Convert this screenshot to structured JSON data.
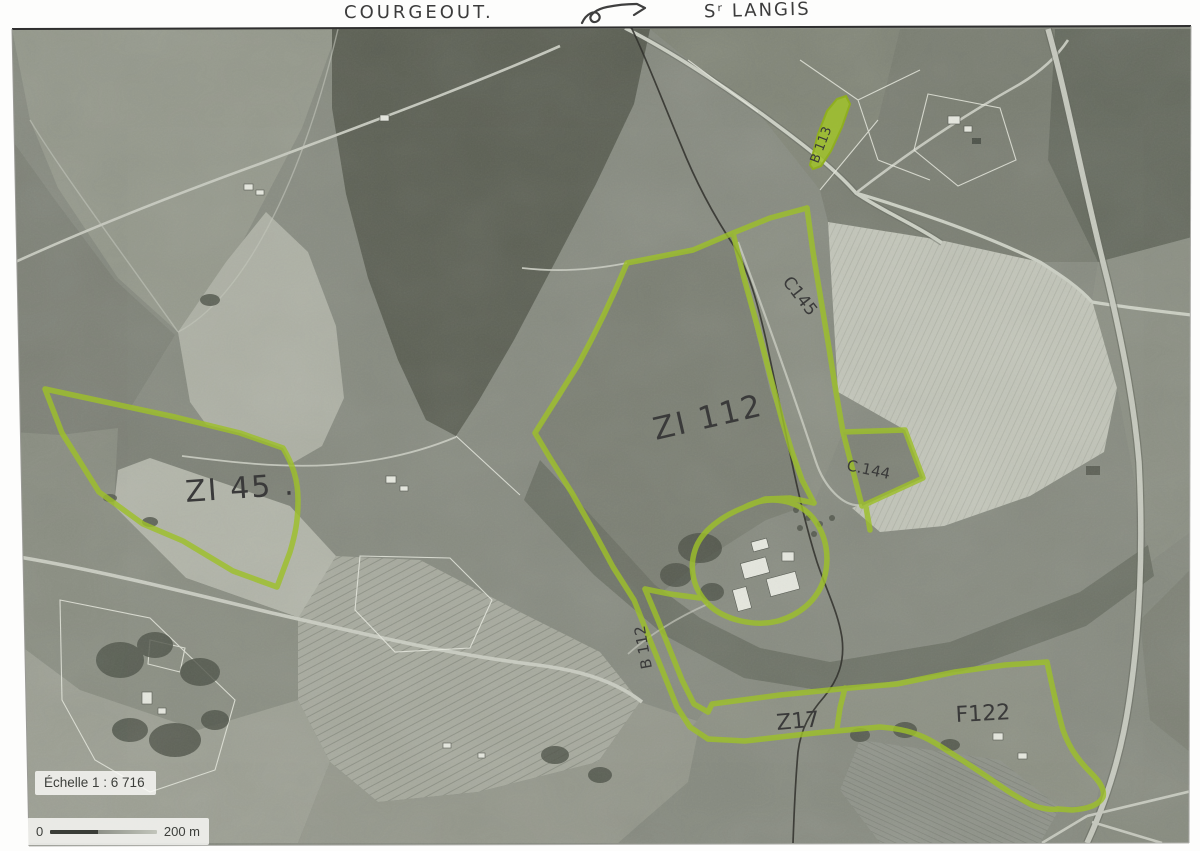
{
  "header": {
    "place_left": "COURGEOUT.",
    "place_right": "Sʳ LANGIS",
    "arrow_icon": "hand-drawn-arrow"
  },
  "map": {
    "scale_label": "Échelle 1 : 6 716",
    "scalebar": {
      "zero": "0",
      "distance": "200 m"
    },
    "highlighter_color": "#9dc02a",
    "pencil_color": "#3a3a3a",
    "parcels": [
      {
        "id": "ZI45",
        "label": "ZI 45 ."
      },
      {
        "id": "ZI112",
        "label": "ZI 112"
      },
      {
        "id": "C145",
        "label": "C145"
      },
      {
        "id": "C144",
        "label": "C.144"
      },
      {
        "id": "B113",
        "label": "B 113"
      },
      {
        "id": "B112",
        "label": "B 112"
      },
      {
        "id": "Z17",
        "label": "Z17"
      },
      {
        "id": "F122",
        "label": "F122"
      }
    ]
  }
}
